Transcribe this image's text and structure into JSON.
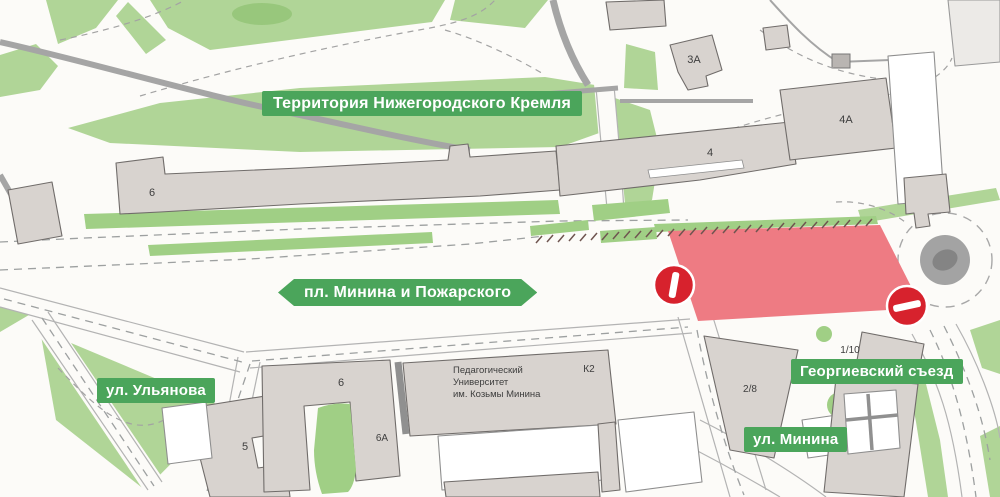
{
  "map_labels": {
    "kremlin_territory": "Территория Нижегородского Кремля",
    "minin_square": "пл. Минина и Пожарского",
    "ulyanova_street": "ул. Ульянова",
    "minina_street": "ул. Минина",
    "georgievsky_descent": "Георгиевский съезд"
  },
  "buildings": {
    "kremlin_building": "6",
    "building_3a": "3А",
    "building_4": "4",
    "building_4a": "4А",
    "building_k2": "К2",
    "university": [
      "Педагогический",
      "Университет",
      "им. Козьмы Минина"
    ],
    "building_6": "6",
    "building_6a": "6А",
    "building_5": "5",
    "building_2_8": "2/8",
    "building_1_10": "1/10"
  },
  "colors": {
    "park_green": "#b0d597",
    "median_green": "#a0cf85",
    "label_green": "#4ba55b",
    "closure_red": "#ee7b83",
    "sign_red": "#d7222d",
    "building_fill": "#d8d3cf",
    "building_stroke": "#706c6a",
    "road_gray": "#a5a5a5"
  }
}
